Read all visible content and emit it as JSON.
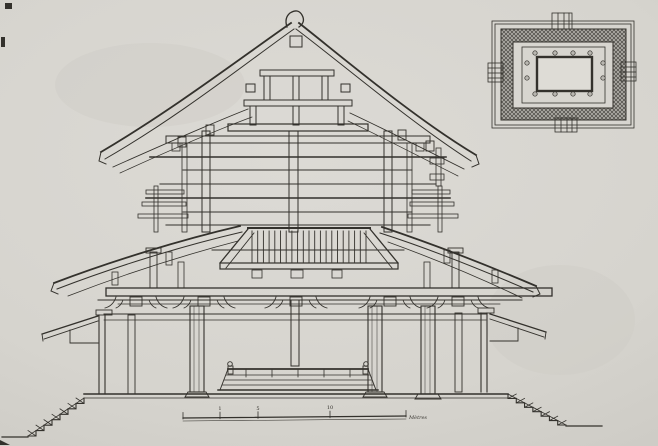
{
  "artwork": {
    "kind": "scanned architectural line drawing",
    "title": "Cross-section of a multi-tiered temple hall",
    "views": {
      "main": "longitudinal cross-section with stepped podium and stairs",
      "inset": "floor plan, top right"
    }
  },
  "colors": {
    "paper": "#d6d4ce",
    "paper_edge": "#bebcb6",
    "ink": "#33312c",
    "ink_light": "#5a5751",
    "hatch_line": "#4a4843",
    "hatch_bg": "#b0aea8",
    "plan_light": "#d7d5cf",
    "plan_core": "#dedcd6",
    "dot_fill": "#b9b7b1"
  },
  "scale_bar": {
    "ticks": [
      {
        "x": 183,
        "label": ""
      },
      {
        "x": 220,
        "label": "1"
      },
      {
        "x": 258,
        "label": "5"
      },
      {
        "x": 330,
        "label": "10"
      },
      {
        "x": 406,
        "label": ""
      }
    ],
    "end_label": "Mètres"
  },
  "generated": {
    "slats": {
      "x0": 252,
      "x1": 367,
      "step": 5.7,
      "y0": 231,
      "y1": 262
    },
    "altar_ticks": {
      "x0": 246,
      "x1": 352,
      "step": 26,
      "y0": 370,
      "y1": 377
    },
    "stairs_left": {
      "x0": 84,
      "y0": 398,
      "x1": 28,
      "y1": 436,
      "steps": 7
    },
    "stairs_right": {
      "x0": 508,
      "y0": 394,
      "x1": 566,
      "y1": 425,
      "steps": 7
    },
    "bracket_xs": [
      136,
      204,
      296,
      390,
      458
    ],
    "bracket_y": 296,
    "plan_dots": [
      [
        535,
        53
      ],
      [
        555,
        53
      ],
      [
        573,
        53
      ],
      [
        590,
        53
      ],
      [
        535,
        94
      ],
      [
        555,
        94
      ],
      [
        573,
        94
      ],
      [
        590,
        94
      ],
      [
        527,
        63
      ],
      [
        527,
        78
      ],
      [
        603,
        63
      ],
      [
        603,
        78
      ]
    ]
  }
}
